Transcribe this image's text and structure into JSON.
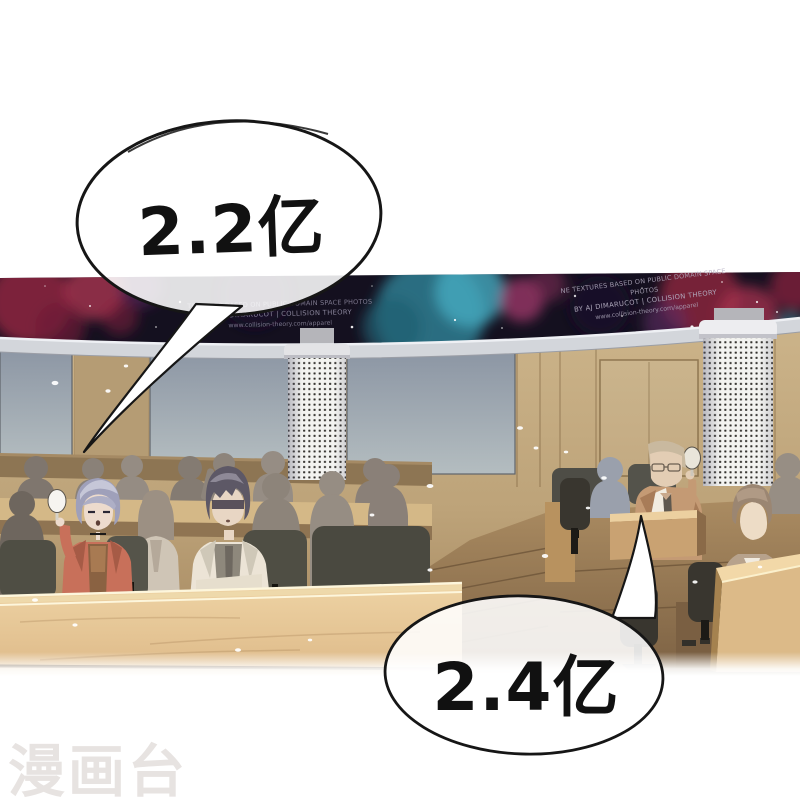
{
  "speech_bubbles": [
    {
      "id": "bid-1",
      "text": "2.2亿"
    },
    {
      "id": "bid-2",
      "text": "2.4亿"
    }
  ],
  "ceiling_credits": {
    "left": {
      "line1": "TEXTURES BASED ON PUBLIC DOMAIN SPACE PHOTOS",
      "line2": "BY AJ DIMARUCOT | COLLISION THEORY",
      "line3": "www.collision-theory.com/apparel"
    },
    "right": {
      "line1": "NE TEXTURES BASED ON PUBLIC DOMAIN SPACE PHOTOS",
      "line2": "BY AJ DIMARUCOT | COLLISION THEORY",
      "line3": "www.collision-theory.com/apparel"
    }
  },
  "watermark": {
    "text": "漫画台"
  },
  "colors": {
    "bubble_outline": "#161616",
    "bubble_fill": "#ffffff",
    "watermark": "#e7e3e1",
    "ceiling_band": "#14101f",
    "nebula_red": "#9e3048",
    "nebula_teal": "#46aabf",
    "nebula_magenta": "#a33a6e",
    "window": "#9aa5ae",
    "wall_wood": "#c2a87c",
    "desk_wood": "#eaca98",
    "jacket_red": "#c8705a",
    "suit_tan": "#c19a74"
  }
}
